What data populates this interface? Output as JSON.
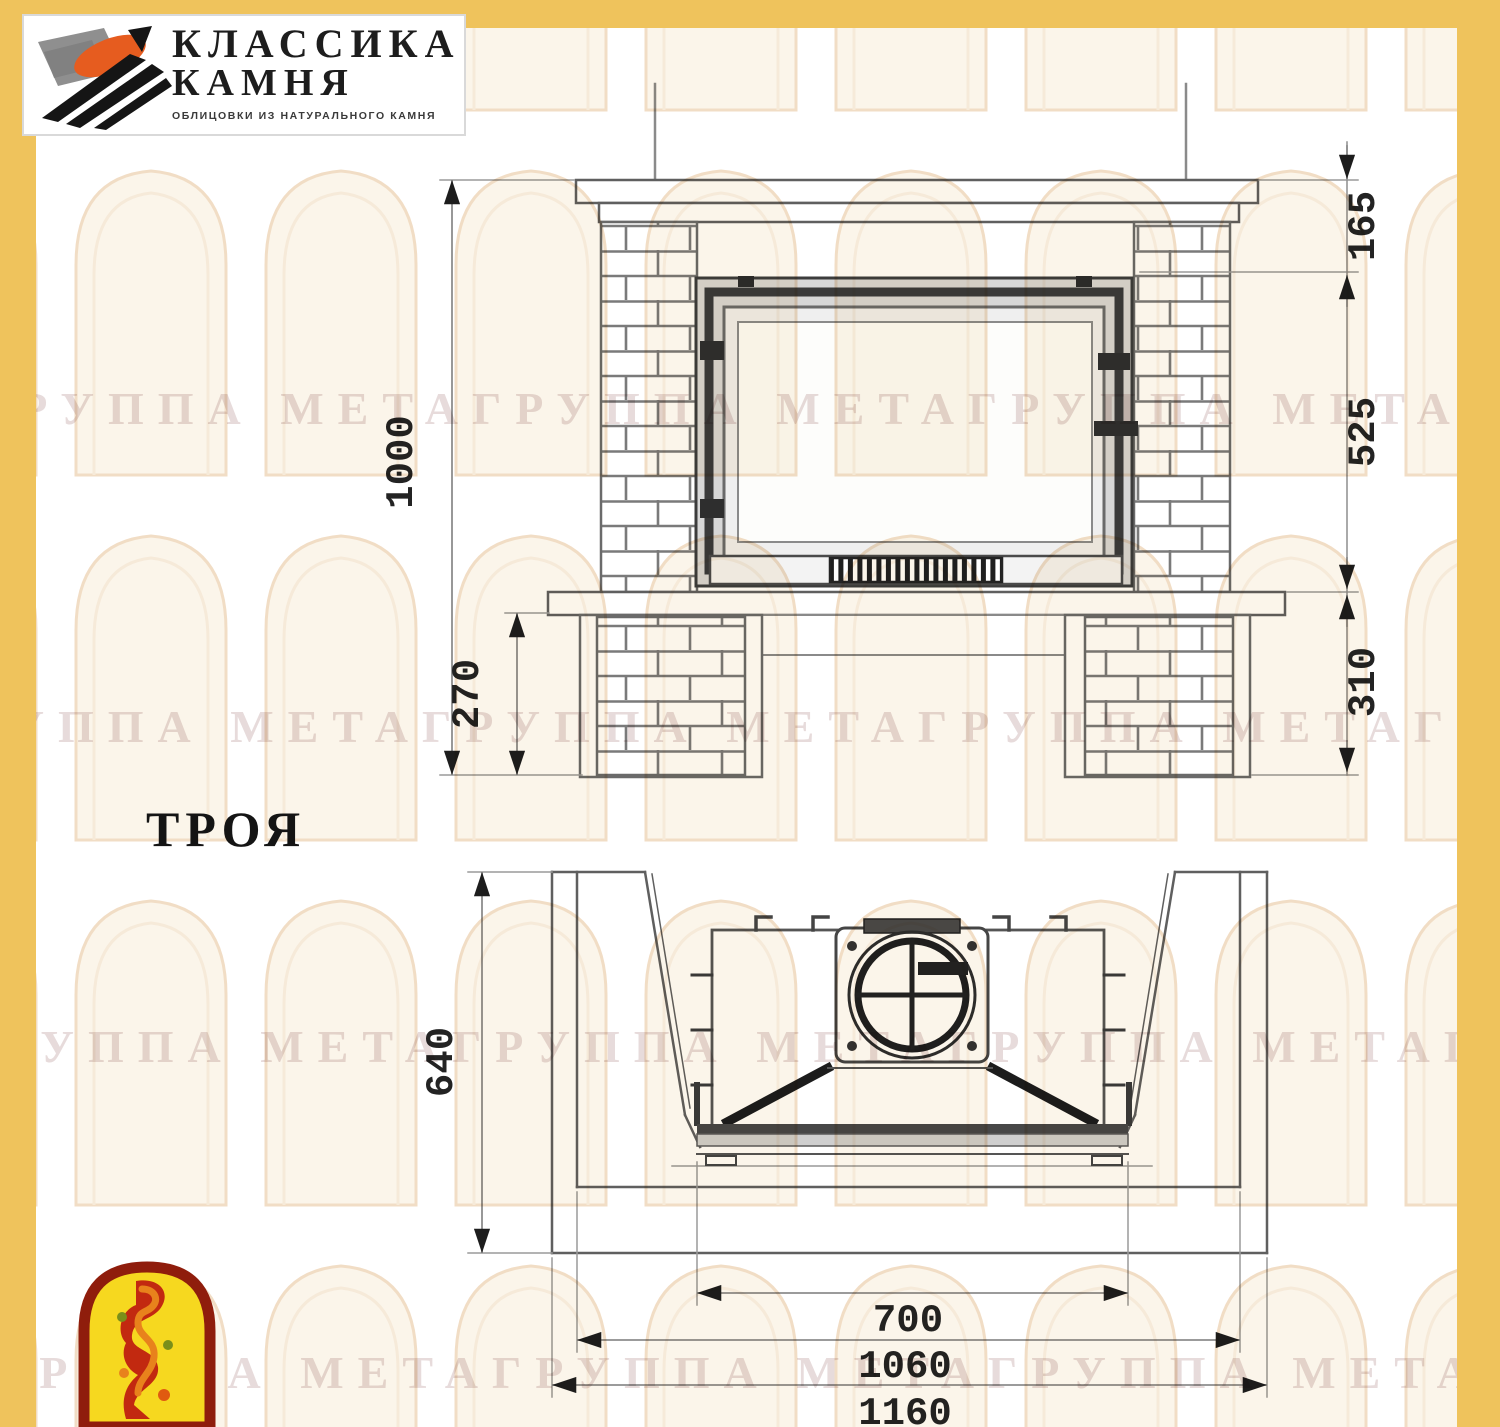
{
  "logo": {
    "title_line1": "КЛАССИКА",
    "title_line2": "КАМНЯ",
    "tagline": "ОБЛИЦОВКИ ИЗ НАТУРАЛЬНОГО КАМНЯ"
  },
  "model": {
    "name": "ТРОЯ"
  },
  "watermark": {
    "row_text": "ГРУППА МЕТАГРУППА МЕТАГРУППА МЕТАГРУППА МЕТА"
  },
  "front_view": {
    "dim_height_total": "1000",
    "dim_top_section": "165",
    "dim_firebox_section": "525",
    "dim_base_section": "310",
    "dim_pedestal_height": "270"
  },
  "plan_view": {
    "dim_depth": "640",
    "dim_opening_width": "700",
    "dim_body_width": "1060",
    "dim_total_width": "1160"
  },
  "colors": {
    "accent_yellow": "#efc35c",
    "line_gray": "#5f5f5f",
    "dark": "#2b2b2b",
    "emblem_red": "#8f1d0c",
    "emblem_yellow": "#f6d81f",
    "logo_orange": "#e65c1f"
  }
}
